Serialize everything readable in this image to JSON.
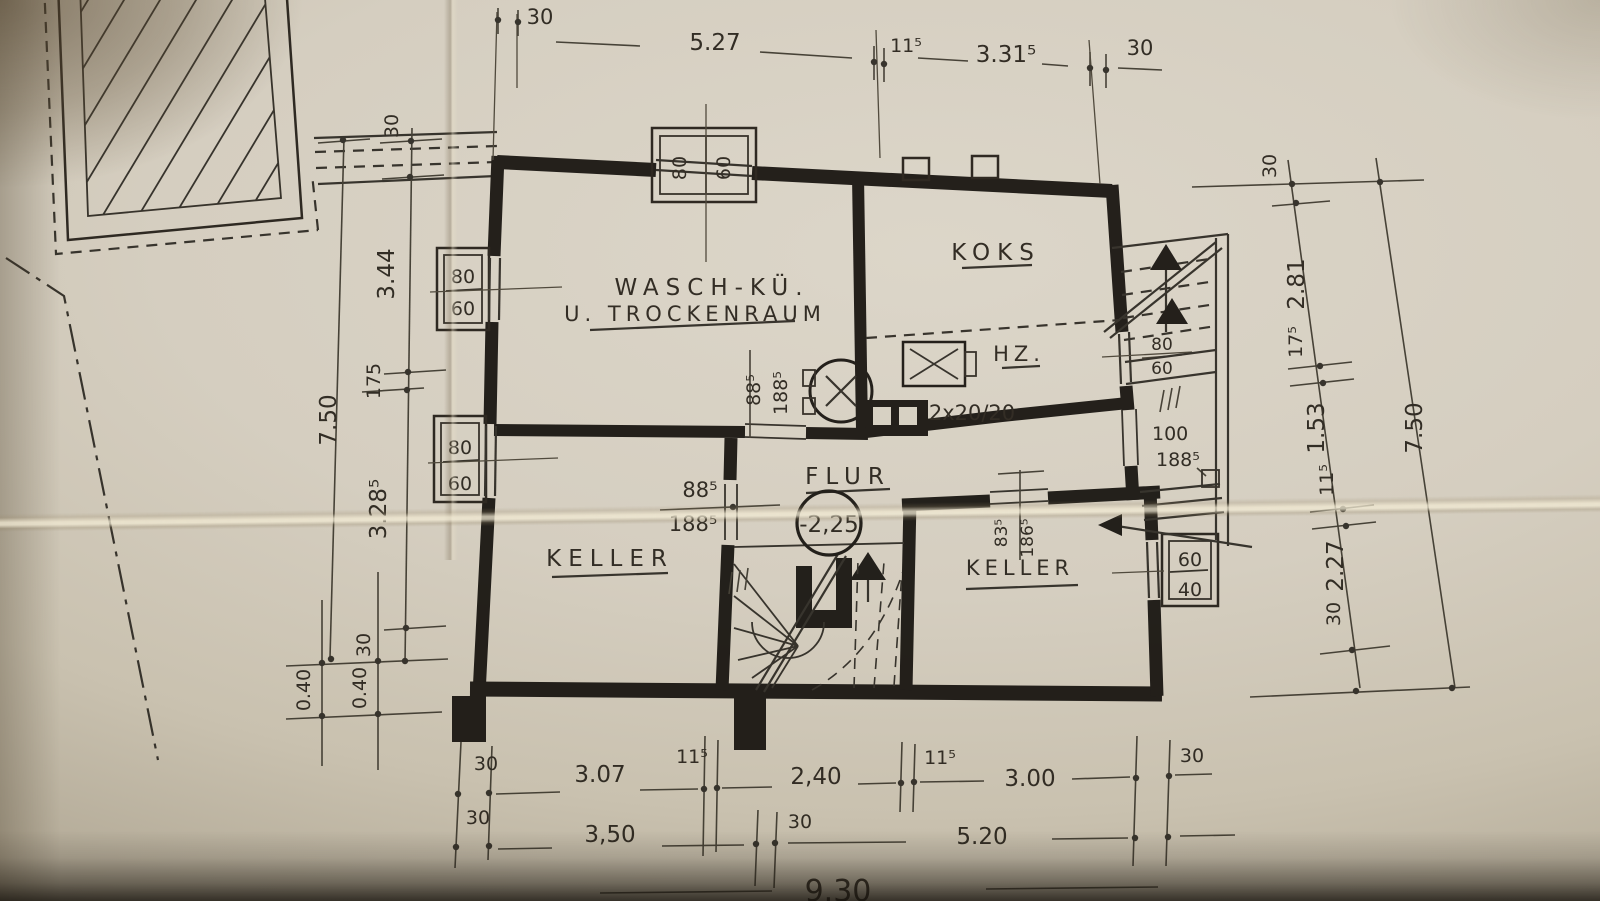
{
  "rooms": {
    "waschkueche_1": "WASCH-KÜ.",
    "waschkueche_2": "U. TROCKENRAUM",
    "koks": "KOKS",
    "hz": "HZ.",
    "flur": "FLUR",
    "flur_level": "-2,25",
    "keller_left": "KELLER",
    "keller_right": "KELLER"
  },
  "openings": {
    "window_top_w": "80",
    "window_top_h": "60",
    "window_left_upper_w": "80",
    "window_left_upper_h": "60",
    "window_left_lower_w": "80",
    "window_left_lower_h": "60",
    "window_stair_w": "80",
    "window_stair_h": "60",
    "window_right_w": "60",
    "window_right_h": "40",
    "door_wasch_w": "88⁵",
    "door_wasch_h": "188⁵",
    "door_keller_left_w": "88⁵",
    "door_keller_left_h": "188⁵",
    "door_keller_right_w": "83⁵",
    "door_keller_right_h": "186⁵",
    "door_exterior_w": "100",
    "door_exterior_h": "188⁵",
    "chimney": "2x20/20"
  },
  "dims": {
    "top": [
      "30",
      "5.27",
      "11⁵",
      "3.31⁵",
      "30"
    ],
    "left": [
      "30",
      "3.44",
      "175",
      "7.50",
      "3.28⁵",
      "30",
      "0.40",
      "0.40"
    ],
    "right": [
      "30",
      "2.81",
      "17⁵",
      "1.53",
      "11⁵",
      "2.27",
      "30",
      "7.50"
    ],
    "b1": [
      "30",
      "3.07",
      "11⁵",
      "2,40",
      "11⁵",
      "3.00",
      "30"
    ],
    "b2": [
      "30",
      "3,50",
      "30",
      "5.20"
    ],
    "b3": [
      "9.30"
    ]
  }
}
